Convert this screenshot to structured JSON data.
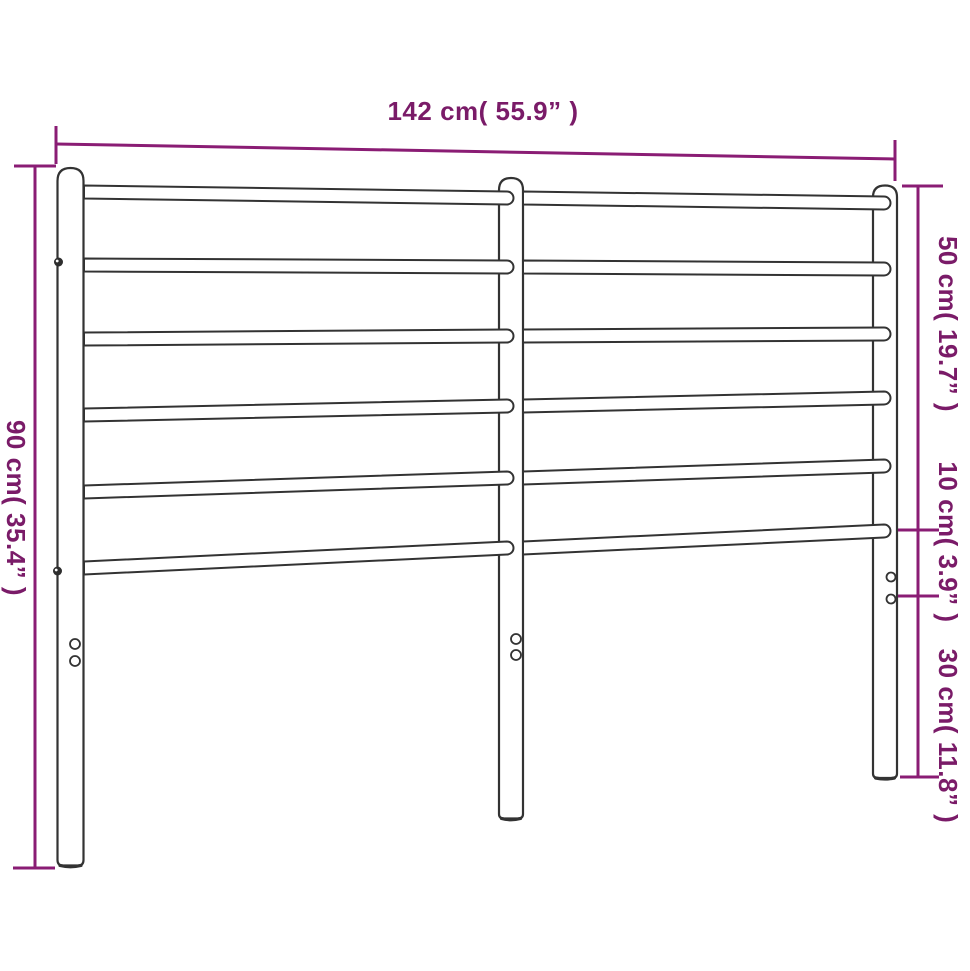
{
  "diagram": {
    "background": "#ffffff",
    "accent_color": "#7a1b68",
    "line_color": "#8a1c74",
    "frame_stroke_color": "#333333",
    "frame_fill_color": "#ffffff",
    "labels": {
      "width": {
        "text": "142 cm( 55.9” )",
        "value_cm": 142,
        "value_inch": 55.9
      },
      "height": {
        "text": "90 cm( 35.4” )",
        "value_cm": 90,
        "value_inch": 35.4
      },
      "segments": [
        {
          "id": "top-of-post-to-bottom-rail",
          "text": "50 cm( 19.7” )",
          "value_cm": 50,
          "value_inch": 19.7
        },
        {
          "id": "bottom-rail-to-mount-hole",
          "text": "10 cm( 3.9” )",
          "value_cm": 10,
          "value_inch": 3.9
        },
        {
          "id": "mount-hole-to-floor",
          "text": "30 cm( 11.8” )",
          "value_cm": 30,
          "value_inch": 11.8
        }
      ]
    },
    "geometry": {
      "rail_thickness": 13,
      "rails": [
        {
          "x1": 84,
          "y1": 192,
          "x2": 507,
          "y2": 198
        },
        {
          "x1": 523,
          "y1": 198,
          "x2": 884,
          "y2": 203
        },
        {
          "x1": 84,
          "y1": 265,
          "x2": 507,
          "y2": 267
        },
        {
          "x1": 523,
          "y1": 267,
          "x2": 884,
          "y2": 269
        },
        {
          "x1": 84,
          "y1": 339,
          "x2": 507,
          "y2": 336
        },
        {
          "x1": 523,
          "y1": 336,
          "x2": 884,
          "y2": 334
        },
        {
          "x1": 84,
          "y1": 415,
          "x2": 507,
          "y2": 406
        },
        {
          "x1": 523,
          "y1": 406,
          "x2": 884,
          "y2": 398
        },
        {
          "x1": 84,
          "y1": 492,
          "x2": 507,
          "y2": 478
        },
        {
          "x1": 523,
          "y1": 478,
          "x2": 884,
          "y2": 466
        },
        {
          "x1": 84,
          "y1": 568,
          "x2": 507,
          "y2": 548
        },
        {
          "x1": 523,
          "y1": 548,
          "x2": 884,
          "y2": 531
        }
      ]
    }
  }
}
